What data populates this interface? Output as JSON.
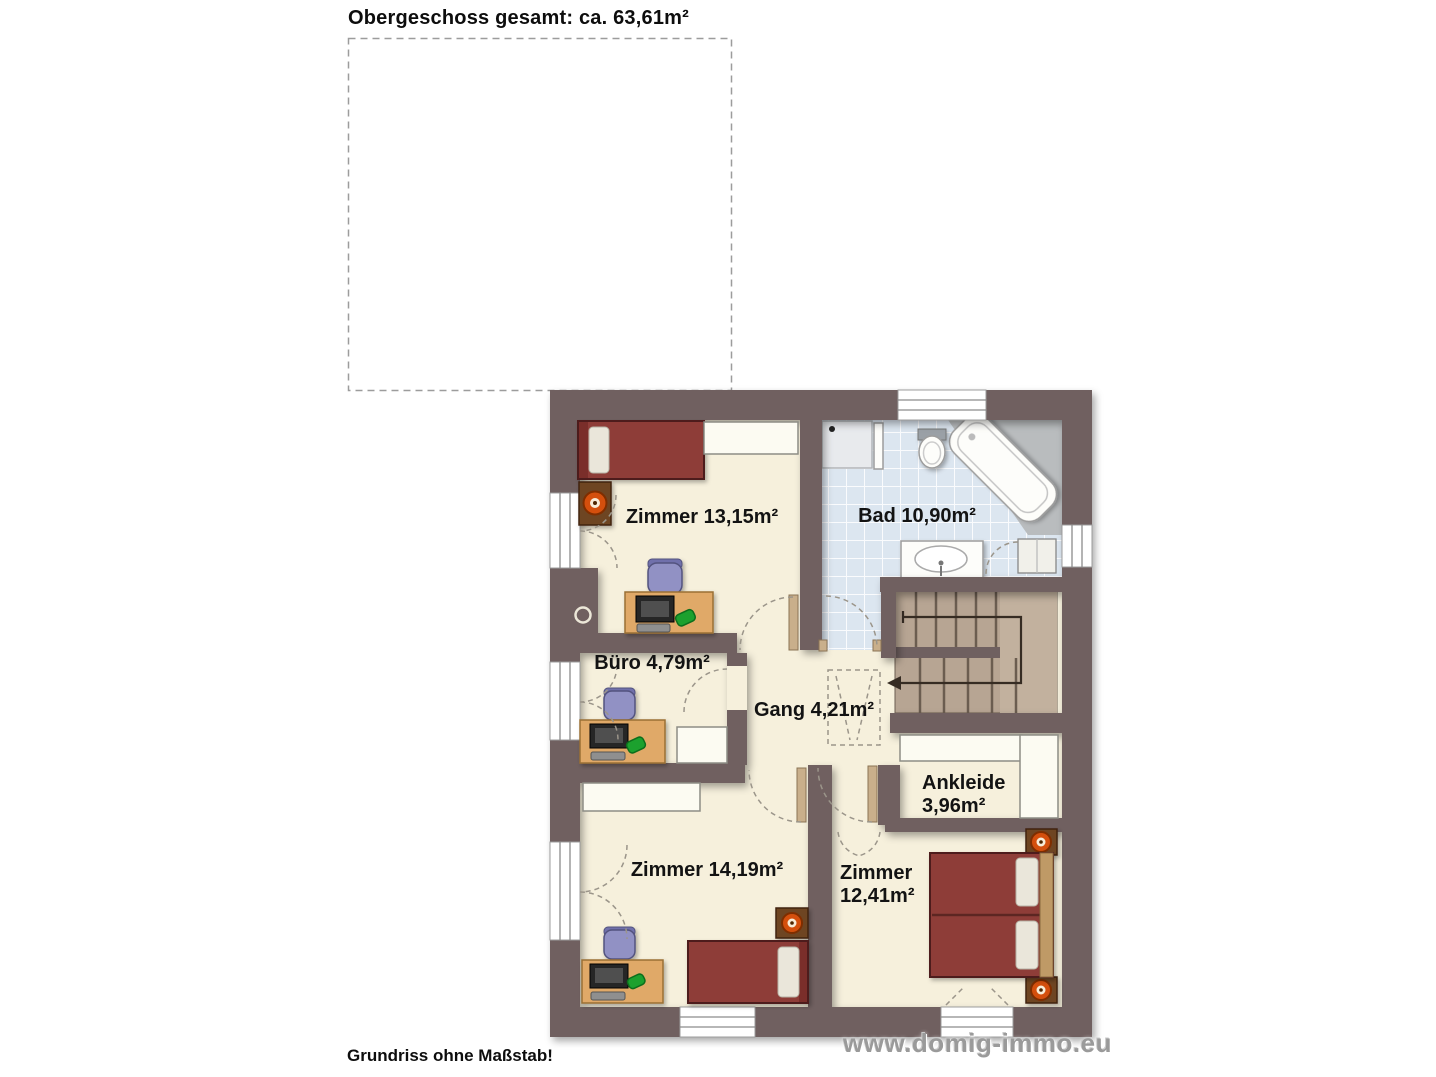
{
  "page": {
    "title": "Obergeschoss gesamt: ca. 63,61m²",
    "footer": "Grundriss ohne Maßstab!",
    "watermark": "www.domig-immo.eu"
  },
  "rooms": {
    "zimmer_top": {
      "label": "Zimmer 13,15m²"
    },
    "bad": {
      "label": "Bad 10,90m²"
    },
    "buero": {
      "label": "Büro 4,79m²"
    },
    "gang": {
      "label": "Gang 4,21m²"
    },
    "ankleide": {
      "name": "Ankleide",
      "area": "3,96m²"
    },
    "zimmer_bottom_left": {
      "label": "Zimmer 14,19m²"
    },
    "zimmer_bottom_right": {
      "name": "Zimmer",
      "area": "12,41m²"
    }
  },
  "colors": {
    "wall": "#6f6060",
    "floor": "#f6f0dc",
    "bath_tile": "#dce6f0",
    "stairs": "#b7a593",
    "bed": "#8e3c38",
    "desk_wood": "#e0a967",
    "lamp": "#d4500a"
  }
}
